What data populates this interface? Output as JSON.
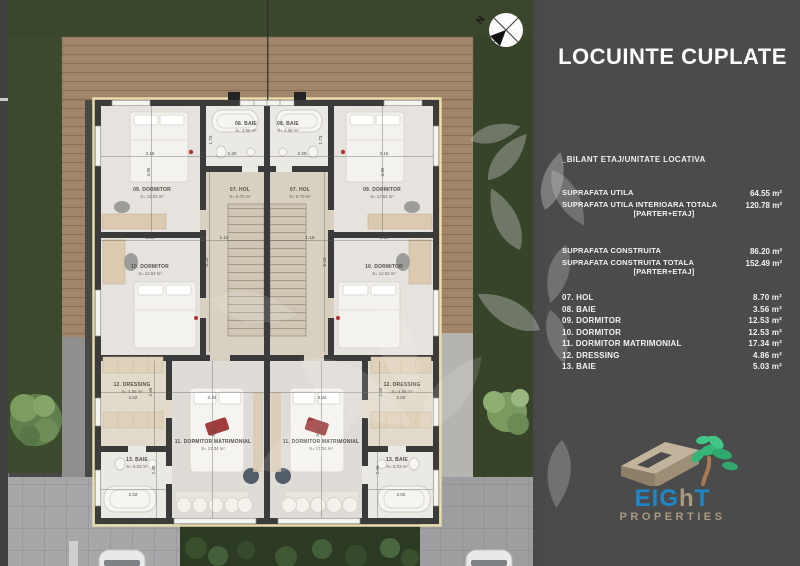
{
  "colors": {
    "background": "#484848",
    "panel_bg": "#4b4b4b",
    "grass": "#3a472c",
    "deck_wood": "#a08568",
    "wall": "#3b3b3b",
    "floor": "#e5e2dd",
    "paving": "#a7a7a9",
    "insulation_line": "#e8dcab",
    "logo_blue": "#1d87c9",
    "logo_tan": "#a89a82",
    "logo_green": "#3cb878"
  },
  "panel": {
    "title": "LOCUINTE CUPLATE",
    "section_heading": "_BILANT ETAJ/UNITATE LOCATIVA",
    "summary": [
      {
        "label": "SUPRAFATA UTILA",
        "value": "64.55 m²"
      },
      {
        "label": "SUPRAFATA UTILA INTERIOARA TOTALA",
        "sub": "[PARTER+ETAJ]",
        "value": "120.78 m²"
      },
      {
        "label": "SUPRAFATA CONSTRUITA",
        "value": "86.20 m²"
      },
      {
        "label": "SUPRAFATA CONSTRUITA TOTALA",
        "sub": "[PARTER+ETAJ]",
        "value": "152.49 m²"
      }
    ],
    "rooms": [
      {
        "label": "07. HOL",
        "value": "8.70 m²"
      },
      {
        "label": "08. BAIE",
        "value": "3.56 m²"
      },
      {
        "label": "09. DORMITOR",
        "value": "12.53 m²"
      },
      {
        "label": "10. DORMITOR",
        "value": "12.53 m²"
      },
      {
        "label": "11. DORMITOR MATRIMONIAL",
        "value": "17.34 m²"
      },
      {
        "label": "12. DRESSING",
        "value": "4.86 m²"
      },
      {
        "label": "13. BAIE",
        "value": "5.03 m²"
      }
    ],
    "logo": {
      "word_part1": "EIG",
      "word_part2": "h",
      "word_part3": "T",
      "subtext": "PROPERTIES"
    }
  },
  "plan": {
    "compass": "N",
    "rooms": {
      "hol": {
        "name": "07. HOL",
        "area": "S= 8.70 m²"
      },
      "baie8": {
        "name": "08. BAIE",
        "area": "S= 3.56 m²"
      },
      "dorm9": {
        "name": "09. DORMITOR",
        "area": "S= 12.53 m²"
      },
      "dorm10": {
        "name": "10. DORMITOR",
        "area": "S= 12.53 m²"
      },
      "matrimonial": {
        "name": "11. DORMITOR MATRIMONIAL",
        "area": "S= 17.34 m²"
      },
      "dressing": {
        "name": "12. DRESSING",
        "area": "S= 4.86 m²"
      },
      "baie13": {
        "name": "13. BAIE",
        "area": "S= 5.03 m²"
      }
    },
    "dims": {
      "w316": "3.16",
      "w220": "2.20",
      "h173": "1.73",
      "h395": "3.95",
      "w15": "15",
      "w25": "25",
      "w116": "1.16",
      "h620": "6.20",
      "w202": "2.02",
      "h255": "2.55",
      "w334": "3.34",
      "h519": "5.19",
      "h249": "2.49"
    }
  }
}
